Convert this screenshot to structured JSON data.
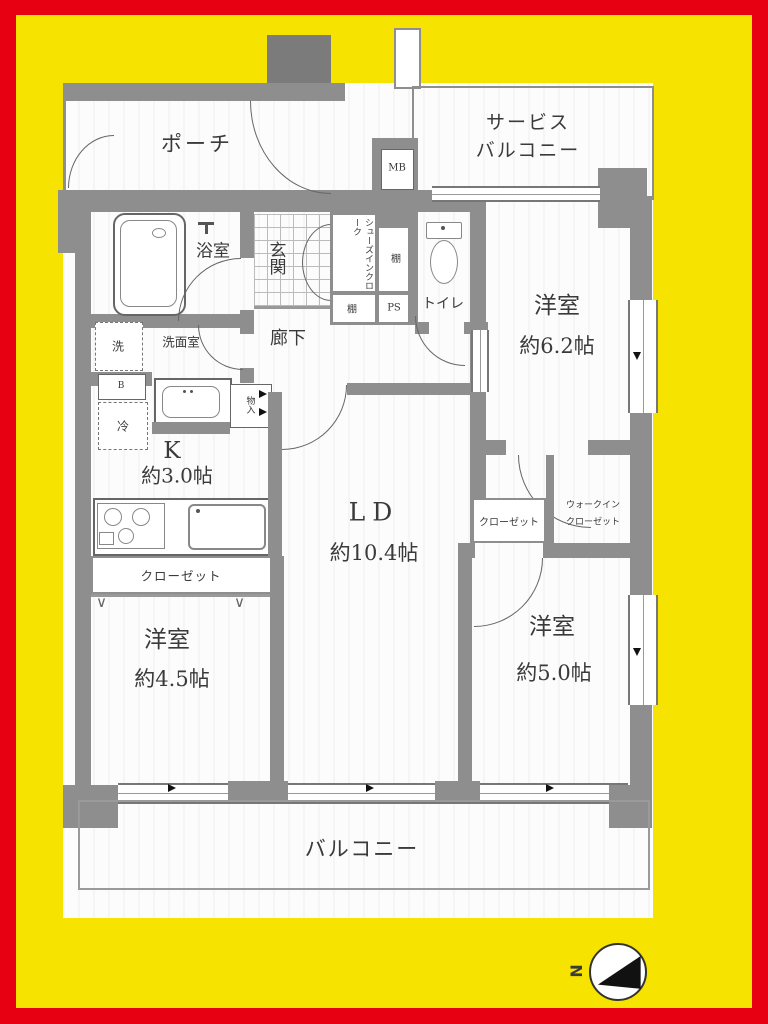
{
  "colors": {
    "frame_red": "#E60012",
    "bg_yellow": "#F6E300",
    "wall_gray": "#8E8E8E",
    "wall_dark": "#7B7B7B",
    "line_gray": "#666666",
    "text": "#3A3A3A"
  },
  "rooms": {
    "porch": {
      "label": "ポーチ"
    },
    "service_balcony": {
      "line1": "サービス",
      "line2": "バルコニー"
    },
    "meter_box": {
      "label": "MB"
    },
    "bathroom": {
      "label": "浴室"
    },
    "entrance": {
      "label": "玄関"
    },
    "shoes_in_closet": {
      "label": "シューズインクローク"
    },
    "shelf_right": {
      "label": "棚"
    },
    "shelf_bottom": {
      "label": "棚"
    },
    "pipe_space": {
      "label": "PS"
    },
    "toilet": {
      "label": "トイレ"
    },
    "western_room_1": {
      "name": "洋室",
      "size": "約6.2帖"
    },
    "corridor": {
      "label": "廊下"
    },
    "washroom": {
      "label": "洗面室"
    },
    "laundry": {
      "label": "洗"
    },
    "b_box": {
      "label": "B"
    },
    "fridge": {
      "label": "冷"
    },
    "storage": {
      "label": "物入"
    },
    "kitchen": {
      "name": "K",
      "size": "約3.0帖"
    },
    "living_dining": {
      "name": "LD",
      "size": "約10.4帖"
    },
    "closet_1": {
      "label": "クローゼット"
    },
    "western_room_2": {
      "name": "洋室",
      "size": "約4.5帖"
    },
    "closet_2": {
      "label": "クローゼット"
    },
    "walk_in_closet": {
      "line1": "ウォークイン",
      "line2": "クローゼット"
    },
    "western_room_3": {
      "name": "洋室",
      "size": "約5.0帖"
    },
    "balcony": {
      "label": "バルコニー"
    }
  },
  "compass": {
    "label": "N"
  }
}
